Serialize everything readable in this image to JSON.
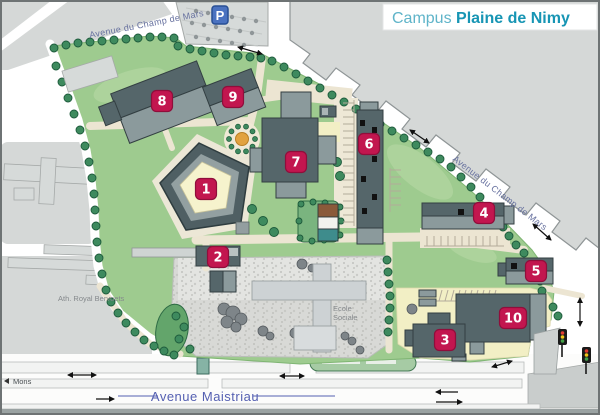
{
  "title": {
    "prefix": "Campus ",
    "name": "Plaine de Nimy"
  },
  "streets": {
    "champ_de_mars_top": "Avenue du Champ de Mars",
    "champ_de_mars_right": "Avenue du Champ de Mars",
    "maistriau": "Avenue Maistriau",
    "mons": "Mons"
  },
  "places": {
    "ath_royal_bervoets": "Ath. Royal Bervoets",
    "ecole_sociale_line1": "Ecole",
    "ecole_sociale_line2": "Sociale",
    "parking": "P"
  },
  "buildings": [
    {
      "number": "1"
    },
    {
      "number": "2"
    },
    {
      "number": "3"
    },
    {
      "number": "4"
    },
    {
      "number": "5"
    },
    {
      "number": "6"
    },
    {
      "number": "7"
    },
    {
      "number": "8"
    },
    {
      "number": "9"
    },
    {
      "number": "10"
    }
  ],
  "colors": {
    "brand_teal": "#1795b4",
    "brand_teal_light": "#5fb4c9",
    "badge": "#c2164f",
    "lawn": "#9ecb8f",
    "street_label": "#67719f",
    "building_dark": "#55666a",
    "building_mid": "#8b9a9c"
  }
}
